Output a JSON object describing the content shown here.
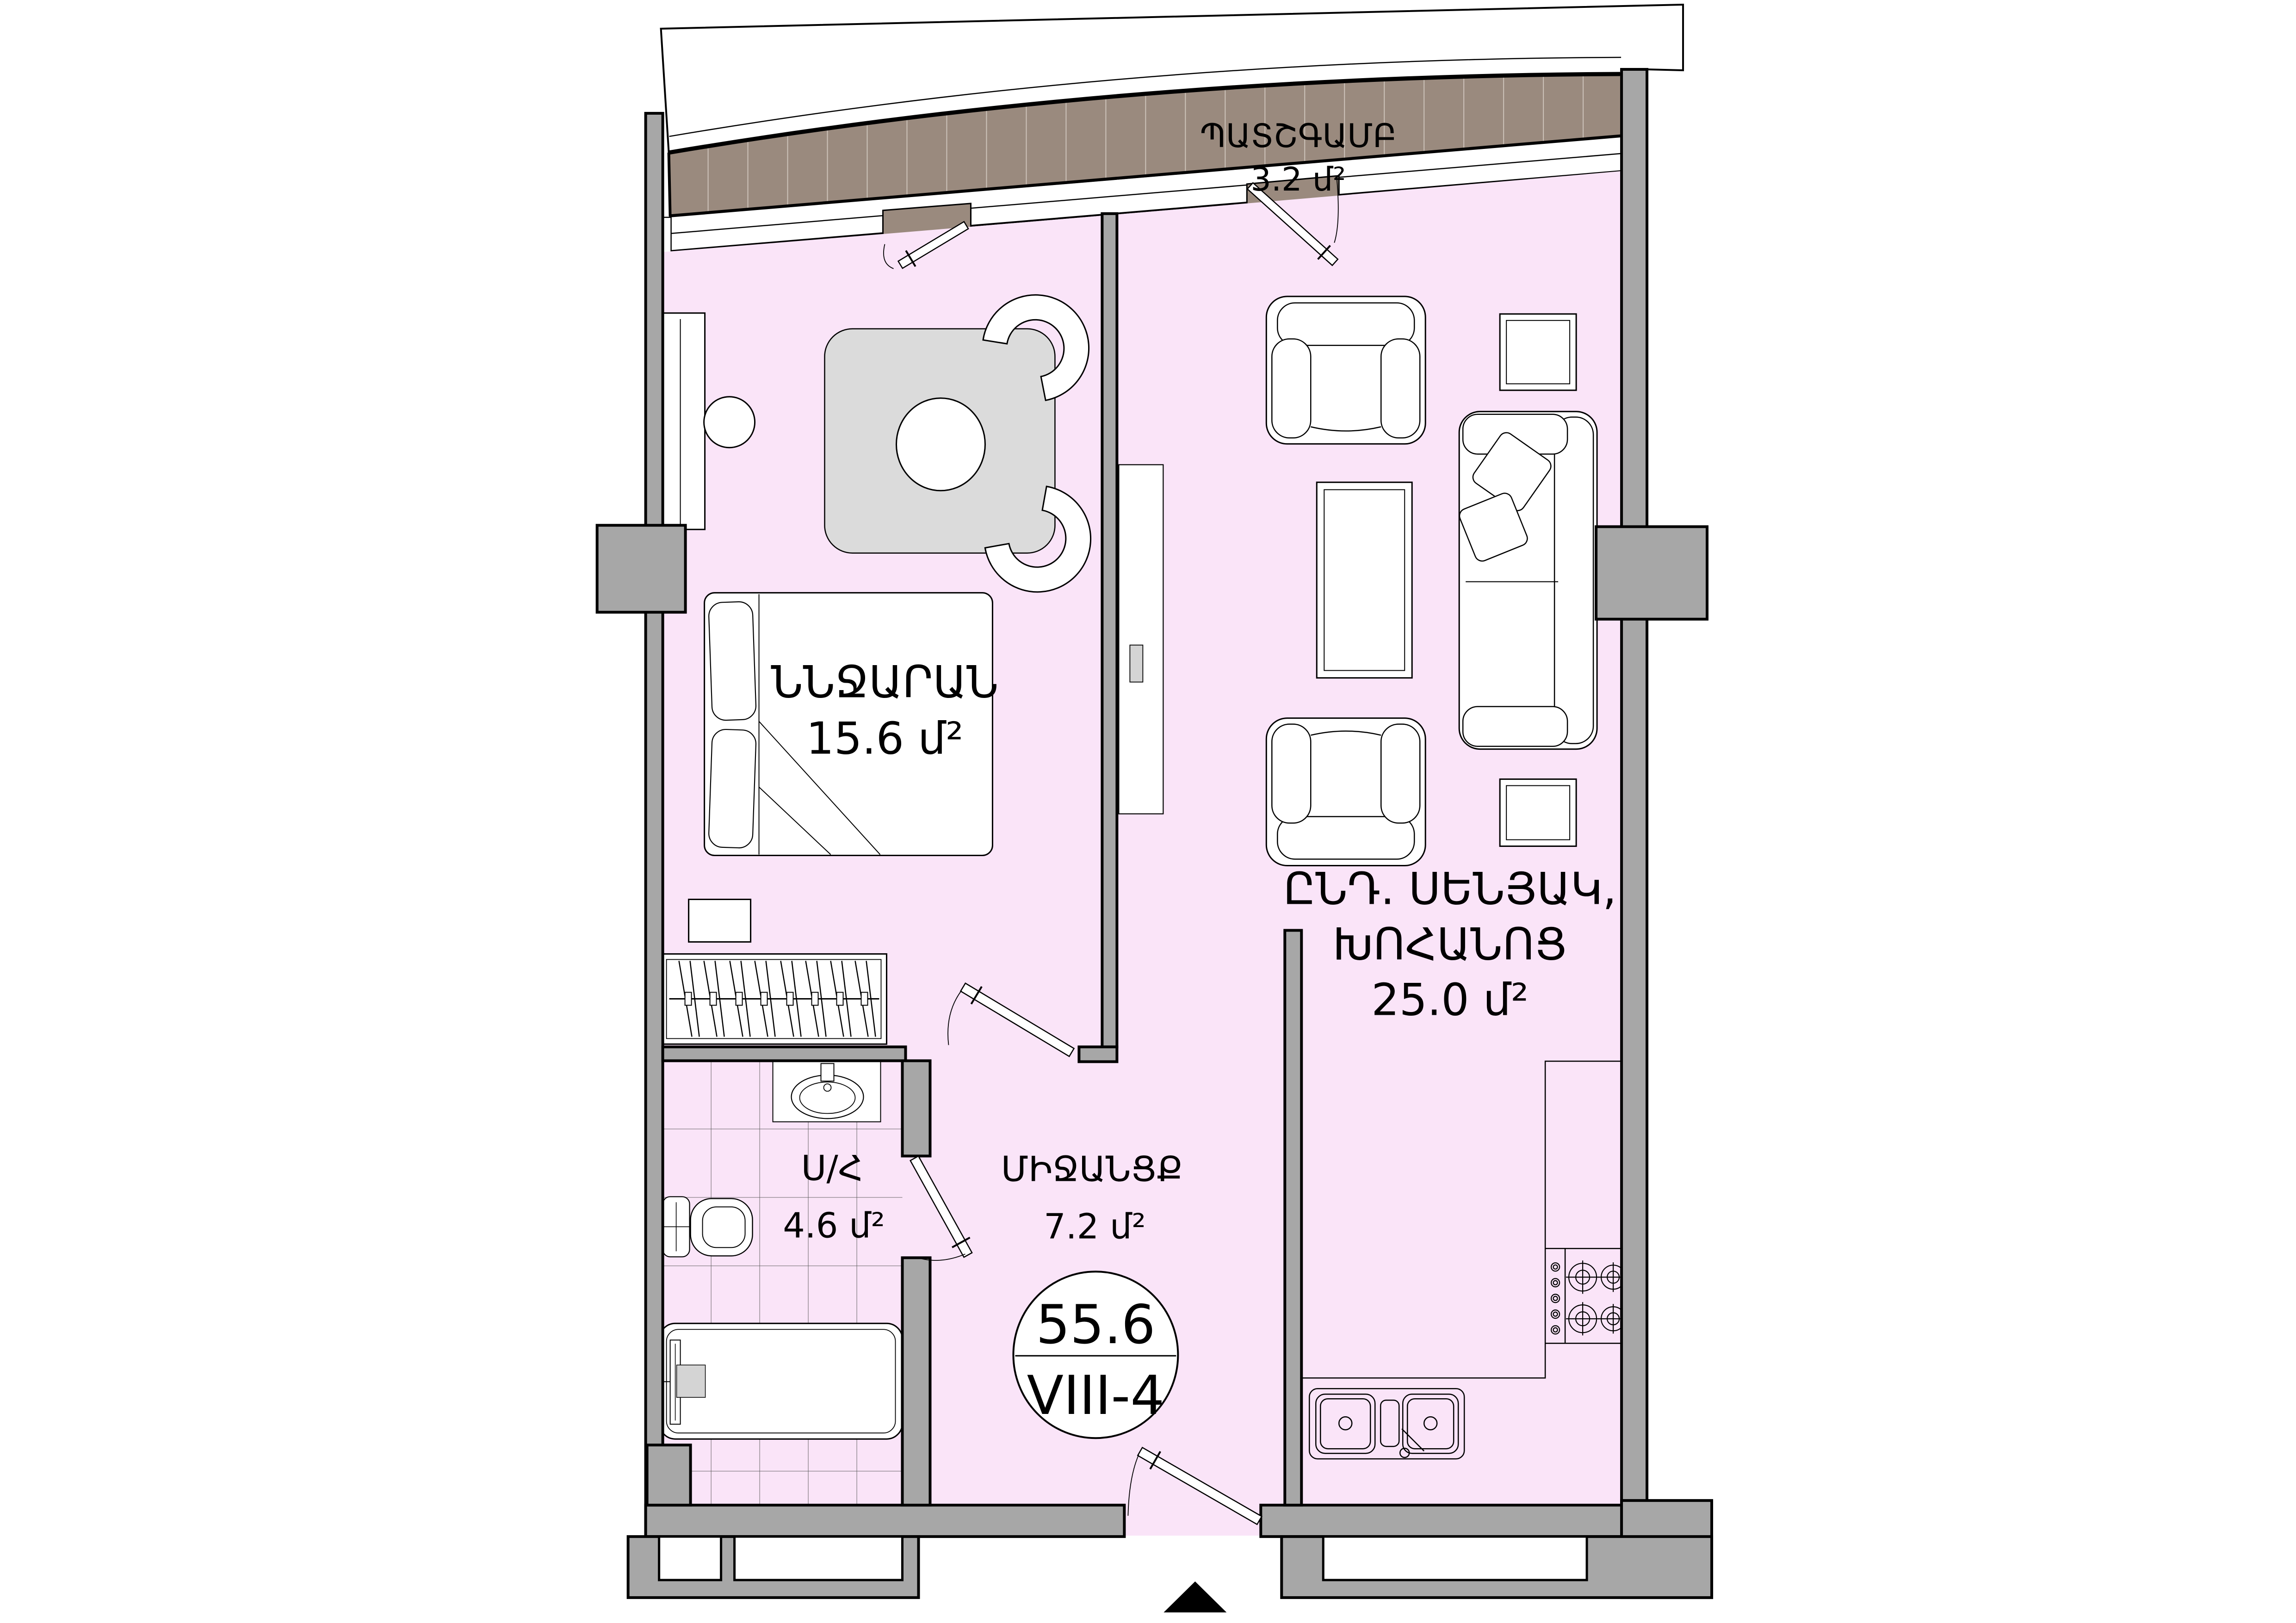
{
  "rooms": {
    "balcony": {
      "label": "ՊԱՏՇԳԱՄԲ",
      "area": "3.2 մ²"
    },
    "bedroom": {
      "label": "ՆՆՋԱՐԱՆ",
      "area": "15.6 մ²"
    },
    "living_kitchen": {
      "label_line1": "ԸՆԴ. ՍԵՆՅԱԿ,",
      "label_line2": "ԽՈՀԱՆՈՑ",
      "area": "25.0 մ²"
    },
    "bathroom": {
      "label": "Ս/Հ",
      "area": "4.6 մ²"
    },
    "hallway": {
      "label": "ՄԻՋԱՆՑՔ",
      "area": "7.2 մ²"
    }
  },
  "badge": {
    "total_area": "55.6",
    "apartment_code": "VIII-4"
  },
  "colors": {
    "floor": "#FAE4F8",
    "balcony_floor": "#9A8A7E",
    "balcony_hatch": "#CDC3BA",
    "walls": "#A7A7A7",
    "rug": "#DBDBDB",
    "accent_fill": "#D4D4D4"
  }
}
